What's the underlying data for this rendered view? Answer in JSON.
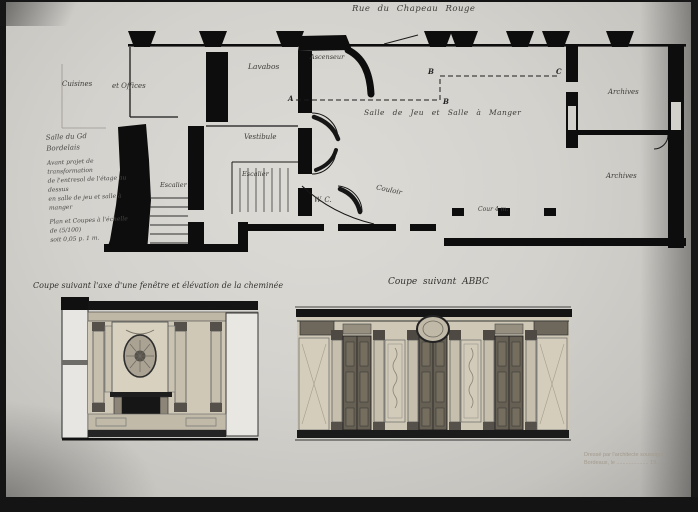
{
  "street_label": "Rue du Chapeau Rouge",
  "caption": {
    "lines": [
      "Salle du Gd",
      "Bordelais",
      "Avant projet de transformation",
      "de l'entresol de l'étage au dessus",
      "en salle de jeu et salle à manger",
      "Plan et Coupes à l'échelle de (5/100)",
      "soit 0,05 p. 1 m."
    ]
  },
  "plan": {
    "rooms": {
      "cuisines": "Cuisines",
      "offices": "et Offices",
      "lavabos": "Lavabos",
      "ascenseur": "Ascenseur",
      "salle": "Salle de Jeu et Salle à Manger",
      "vestibule": "Vestibule",
      "escalier_service": "Escalier",
      "escalier_main": "Escalier",
      "wc": "W. C.",
      "couloir": "Couloir",
      "cour": "Cour 4 m.",
      "archives_top": "Archives",
      "archives_bottom": "Archives"
    },
    "section_markers": [
      "A",
      "B",
      "B",
      "C"
    ]
  },
  "sections": {
    "left_title": "Coupe suivant l'axe d'une fenêtre et élévation de la cheminée",
    "right_title": "Coupe suivant ABBC"
  },
  "stamp": {
    "line1": "Dressé par l'architecte soussigné",
    "line2": "Bordeaux, le ..................... 19.."
  },
  "colors": {
    "paper": "#d4d2cd",
    "ink": "#0d0d0d",
    "wash_light": "#cfc8b6",
    "wash_mid": "#b9b2a0",
    "door": "#665f53"
  }
}
